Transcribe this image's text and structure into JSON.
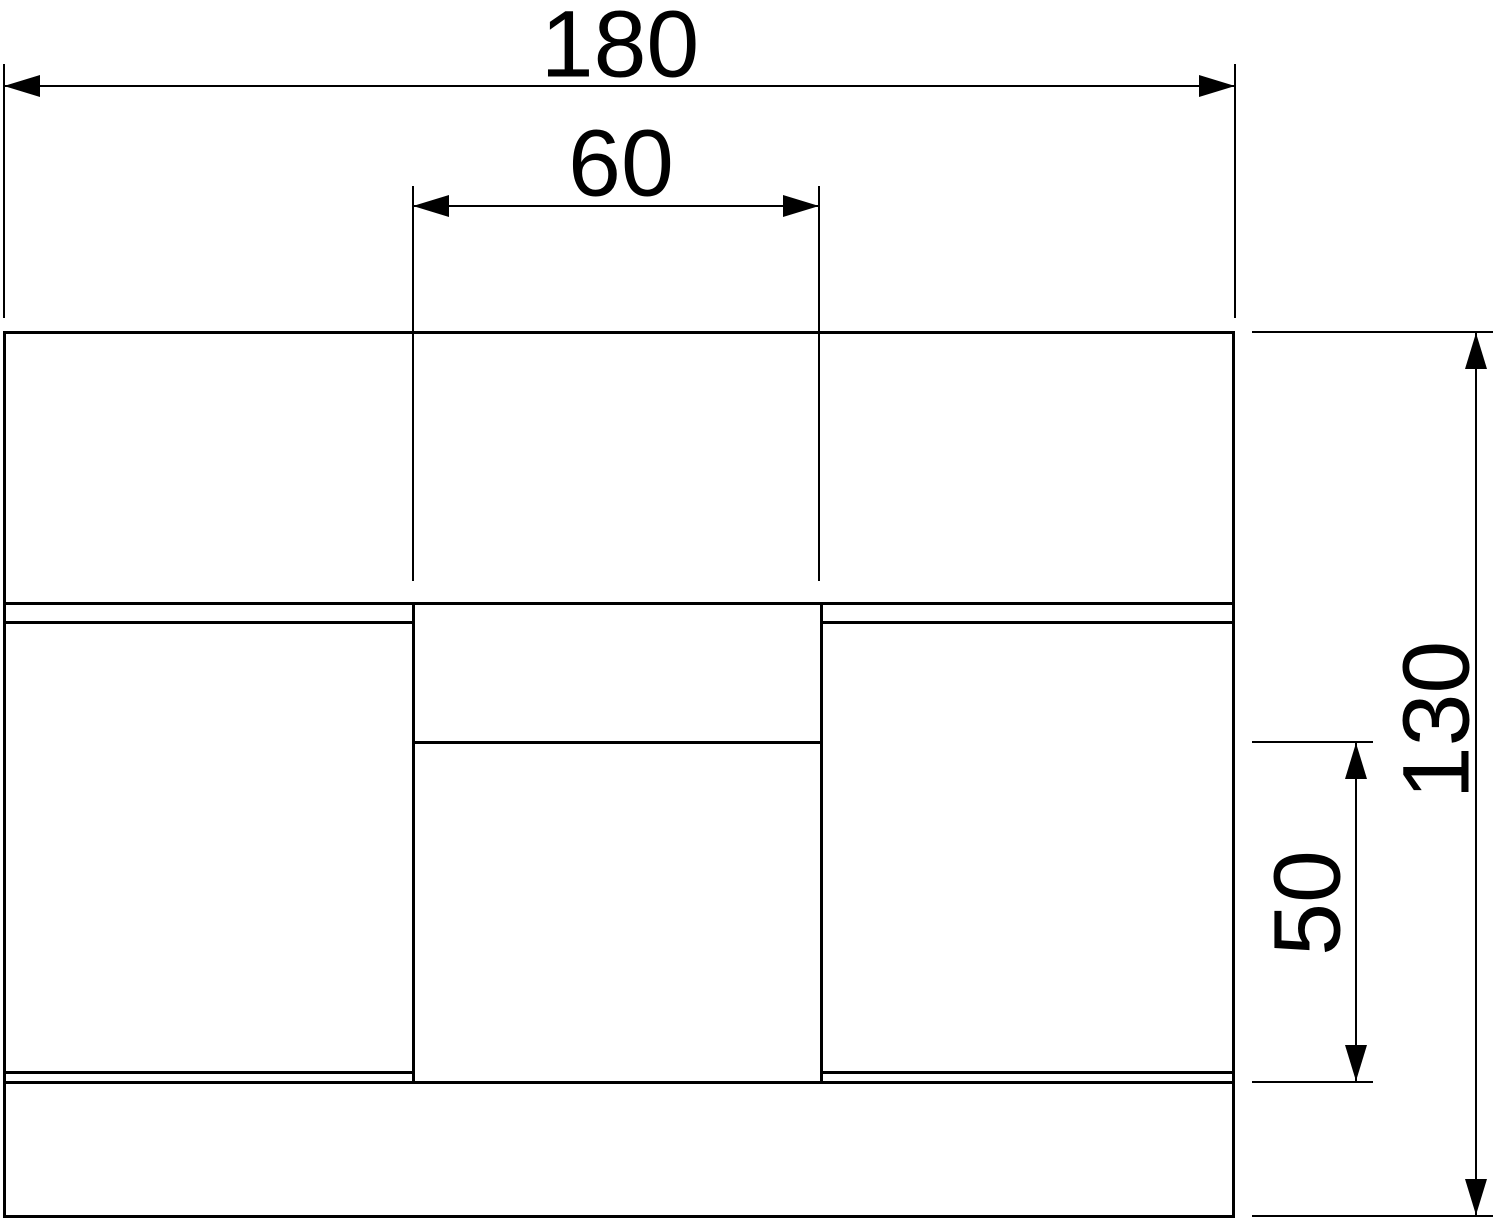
{
  "page": {
    "background": "#ffffff"
  },
  "drawing": {
    "type": "technical-dimension-drawing",
    "line_color": "#000000",
    "text_color": "#000000",
    "dimensions": [
      {
        "id": "overall-width",
        "label": "180",
        "orientation": "horizontal"
      },
      {
        "id": "inner-width",
        "label": "60",
        "orientation": "horizontal"
      },
      {
        "id": "overall-height",
        "label": "130",
        "orientation": "vertical"
      },
      {
        "id": "inner-height",
        "label": "50",
        "orientation": "vertical"
      }
    ]
  }
}
